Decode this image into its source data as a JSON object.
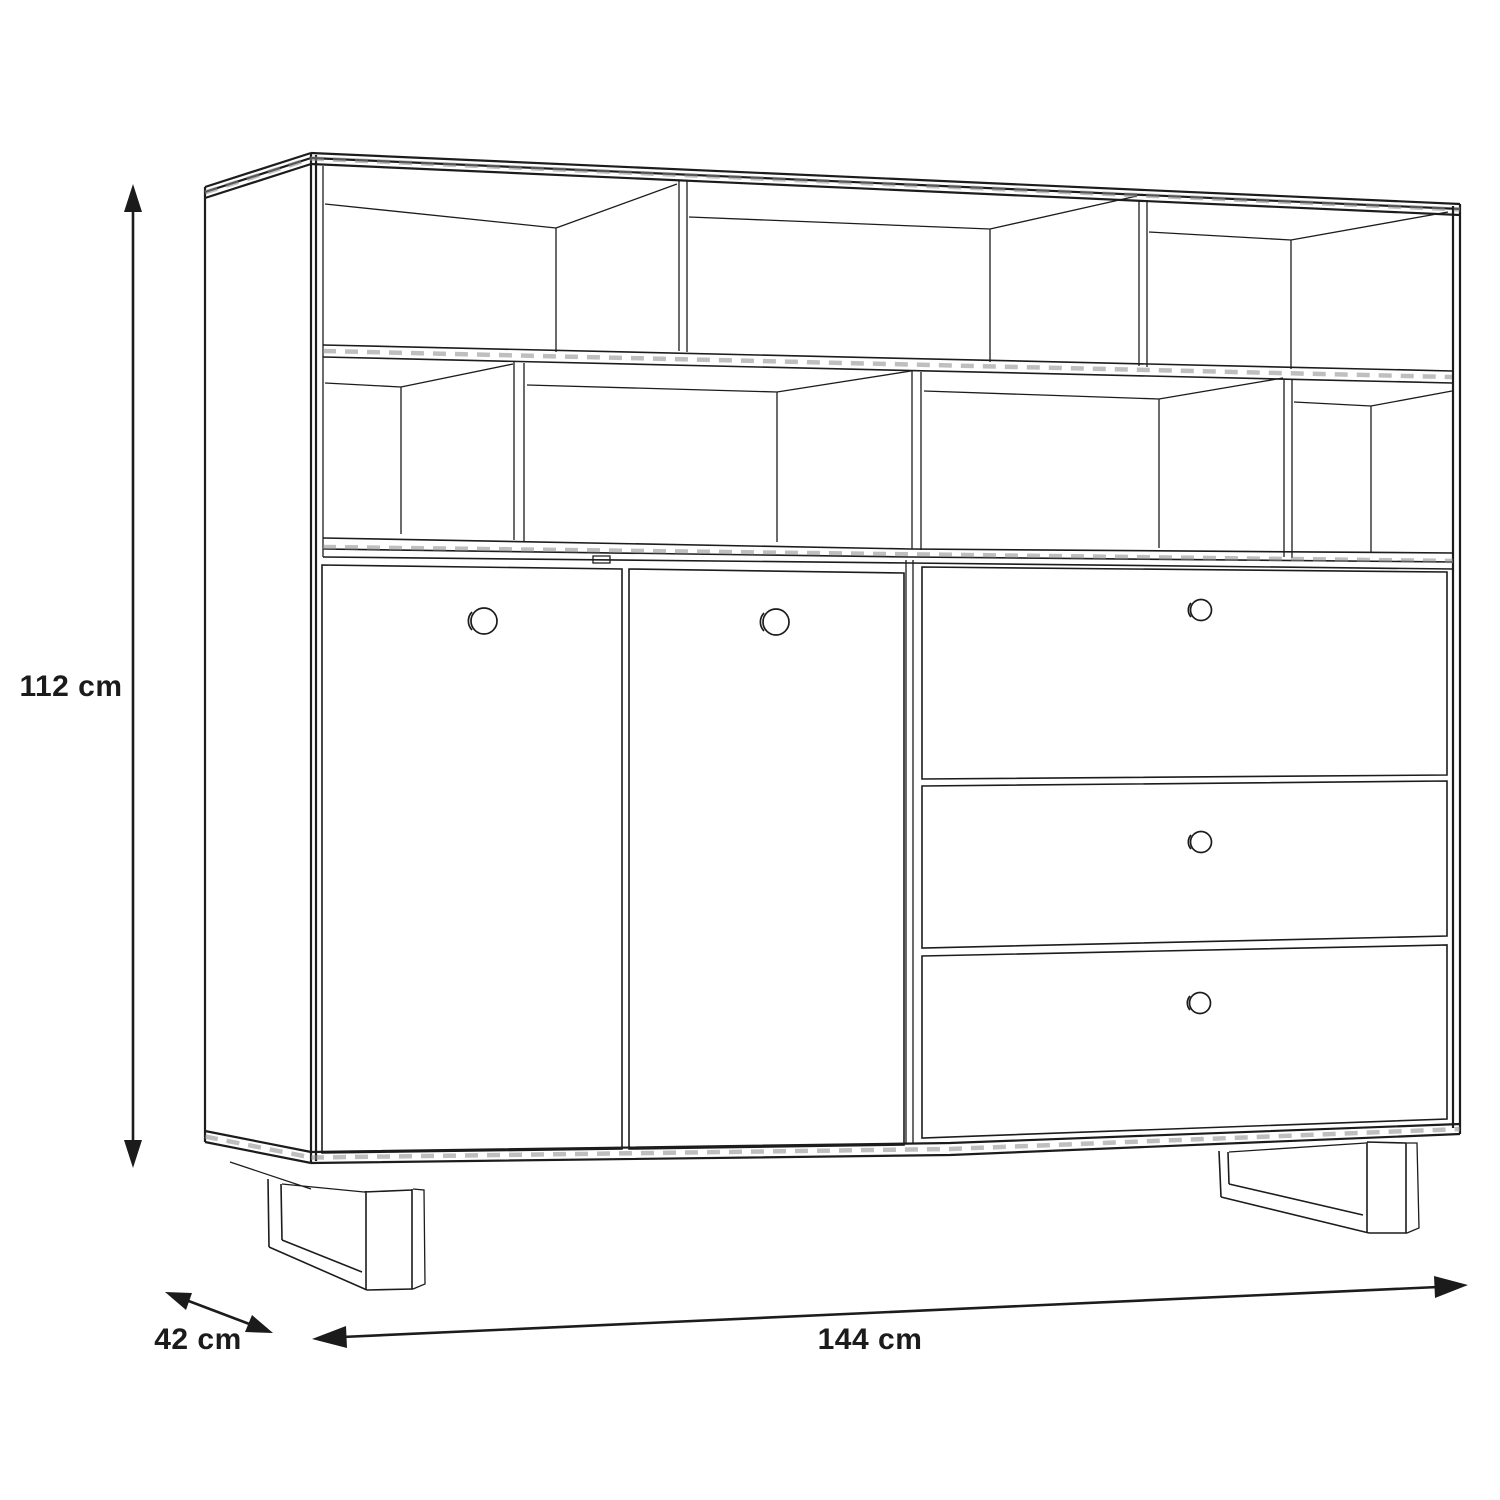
{
  "diagram": {
    "type": "furniture-dimension-drawing",
    "subject": "highboard cabinet line drawing with two rows of open shelf compartments, two doors, three drawers and two metal sled legs",
    "background_color": "#ffffff",
    "line_color": "#1c1c1c",
    "dimensions": {
      "height": {
        "label": "112 cm",
        "value": 112,
        "unit": "cm",
        "arrow": "vertical double-headed, left of cabinet"
      },
      "depth": {
        "label": "42 cm",
        "value": 42,
        "unit": "cm",
        "arrow": "diagonal double-headed, lower left"
      },
      "width": {
        "label": "144 cm",
        "value": 144,
        "unit": "cm",
        "arrow": "horizontal double-headed, below cabinet"
      }
    },
    "structure": {
      "open_shelf_rows": 2,
      "compartments_top_row": 3,
      "compartments_middle_row": 4,
      "doors": 2,
      "drawers": 3,
      "knobs": 5,
      "legs": 2,
      "leg_type": "sled"
    }
  }
}
